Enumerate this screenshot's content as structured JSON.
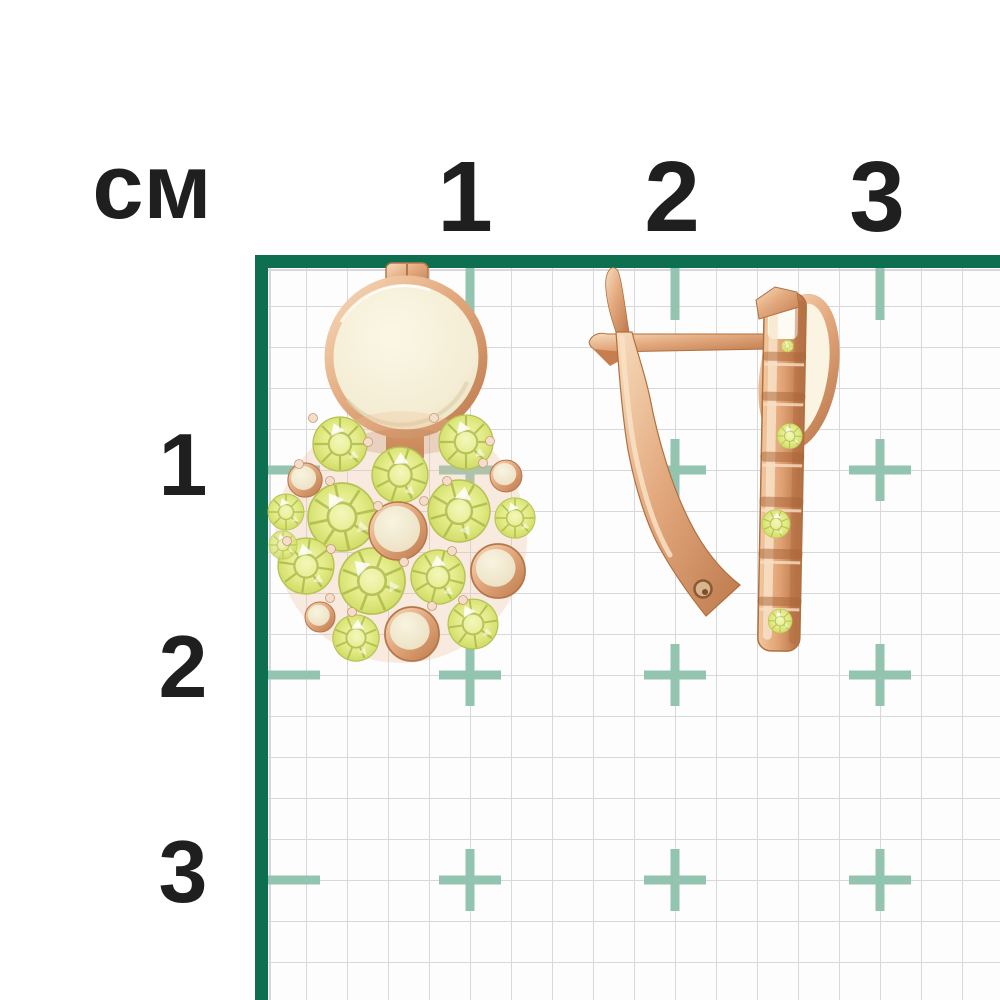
{
  "page": {
    "background_color": "#ffffff"
  },
  "ruler": {
    "unit_label": "см",
    "axis_numbers_top": [
      "1",
      "2",
      "3"
    ],
    "axis_numbers_left": [
      "1",
      "2",
      "3"
    ],
    "text_color": "#1f1f1f"
  },
  "grid": {
    "border_color": "#0d6e50",
    "line_color": "#d8d8dc",
    "marker_color": "#93c4b0",
    "minor_cell_px": 41,
    "centimeter_px": 205
  },
  "photo": {
    "subject": "rose-gold earrings with yellow-green gemstones",
    "left_view": "front view: polished round disc above a round cluster of faceted gems and gold cabochons",
    "right_view": "side view: english-lock hook with tilted gem-set column",
    "metal_color": "#dfa077",
    "gem_color": "#dde878",
    "inlay_color": "#f2ead2"
  }
}
